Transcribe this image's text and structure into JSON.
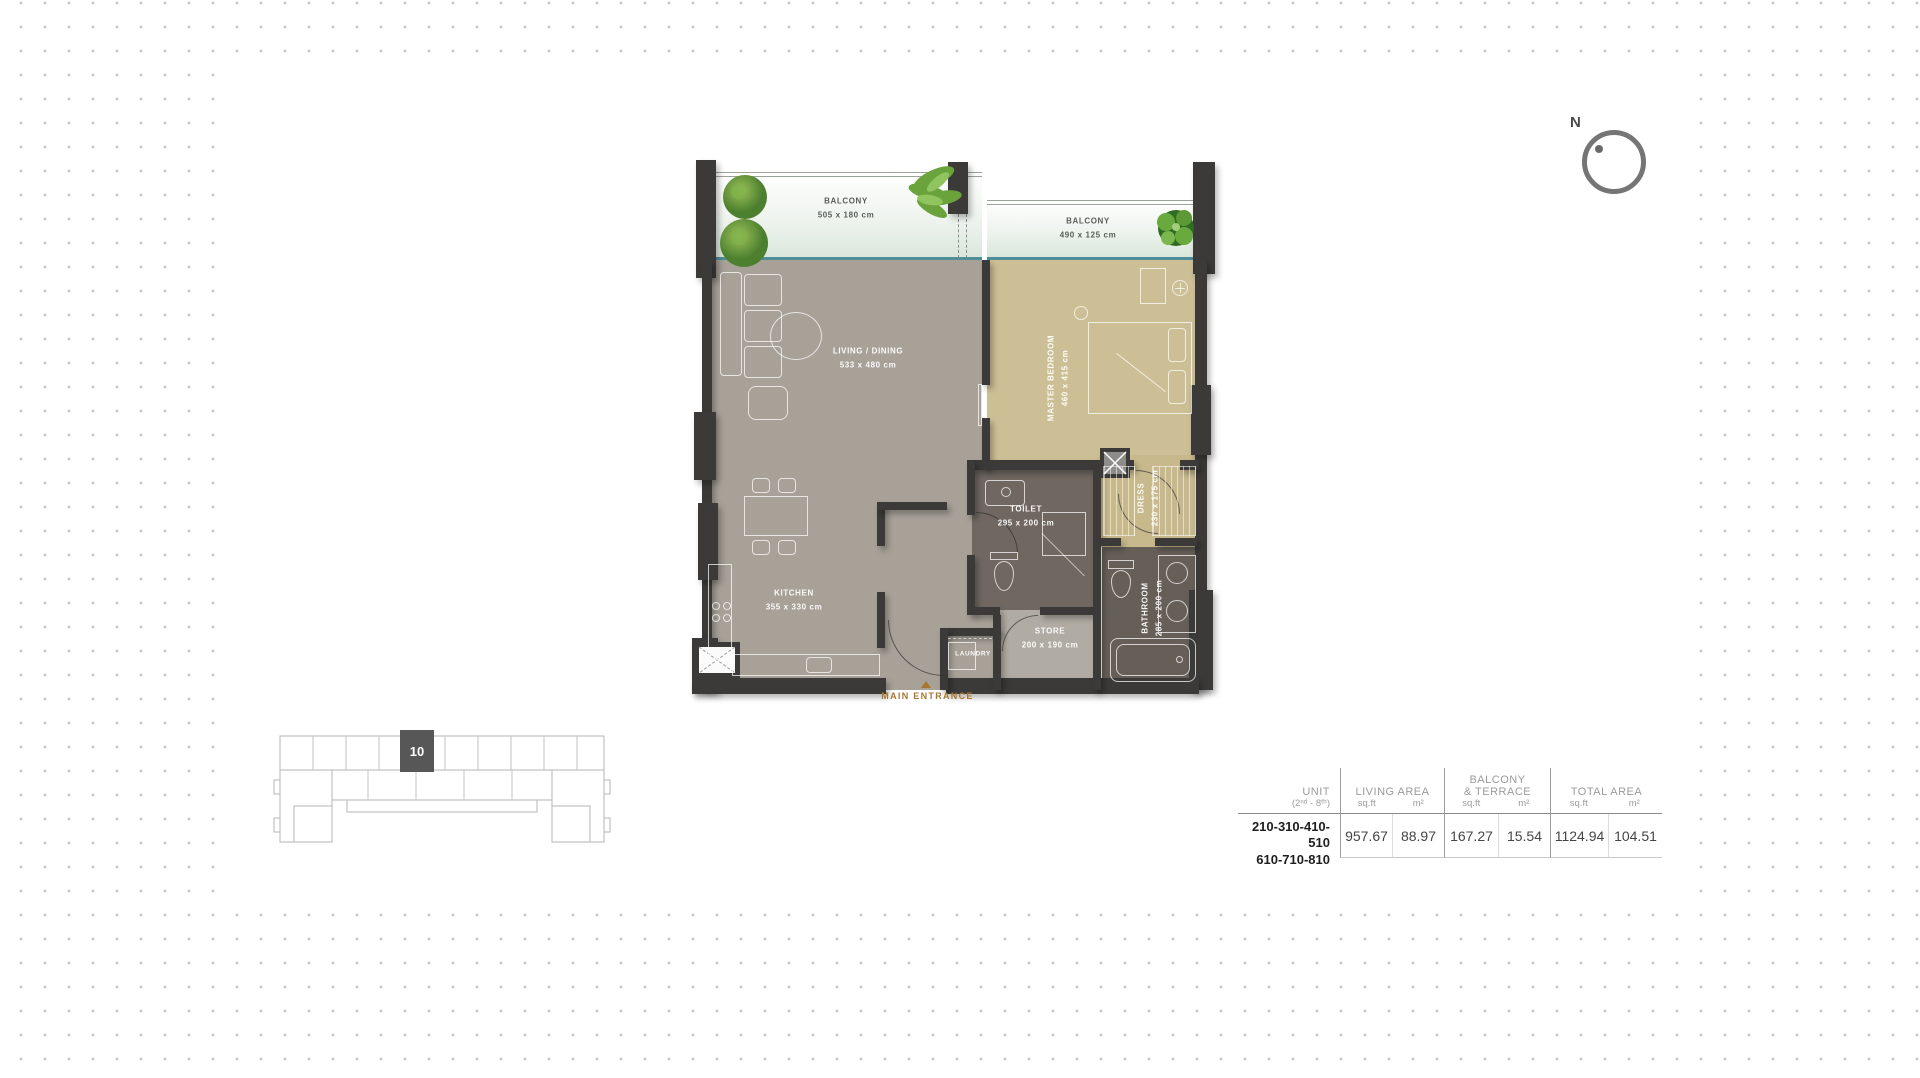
{
  "compass": {
    "label": "N"
  },
  "plan": {
    "rooms": {
      "balcony1": {
        "name": "BALCONY",
        "dims": "505 x 180 cm"
      },
      "balcony2": {
        "name": "BALCONY",
        "dims": "490 x 125 cm"
      },
      "living": {
        "name": "LIVING / DINING",
        "dims": "533 x 480 cm"
      },
      "bedroom": {
        "name": "MASTER BEDROOM",
        "dims": "460 x 415 cm"
      },
      "kitchen": {
        "name": "KITCHEN",
        "dims": "355 x 330 cm"
      },
      "toilet": {
        "name": "TOILET",
        "dims": "295 x 200 cm"
      },
      "store": {
        "name": "STORE",
        "dims": "200 x 190 cm"
      },
      "laundry": {
        "name": "LAUNDRY"
      },
      "dress": {
        "name": "DRESS",
        "dims": "230 x 175 cm"
      },
      "bathroom": {
        "name": "BATHROOM",
        "dims": "285 x 200 cm"
      }
    },
    "entrance_label": "MAIN ENTRANCE"
  },
  "keyplan": {
    "unit_number": "10"
  },
  "table": {
    "headers": {
      "unit_line1": "UNIT",
      "unit_line2": "(2ⁿᵈ - 8ᵗʰ)",
      "living_area": "LIVING AREA",
      "balcony_line1": "BALCONY",
      "balcony_line2": "& TERRACE",
      "total_area": "TOTAL AREA",
      "sqft": "sq.ft",
      "m2": "m²"
    },
    "row": {
      "unit_line1": "210-310-410-510",
      "unit_line2": "610-710-810",
      "living_sqft": "957.67",
      "living_m2": "88.97",
      "balcony_sqft": "167.27",
      "balcony_m2": "15.54",
      "total_sqft": "1124.94",
      "total_m2": "104.51"
    }
  },
  "colors": {
    "wall": "#3b3a38",
    "living_floor": "#a7a198",
    "bedroom_floor": "#cdbf95",
    "wet_floor": "#6a635c",
    "balcony_edge": "#4f8e97",
    "entrance_accent": "#a8762f"
  }
}
